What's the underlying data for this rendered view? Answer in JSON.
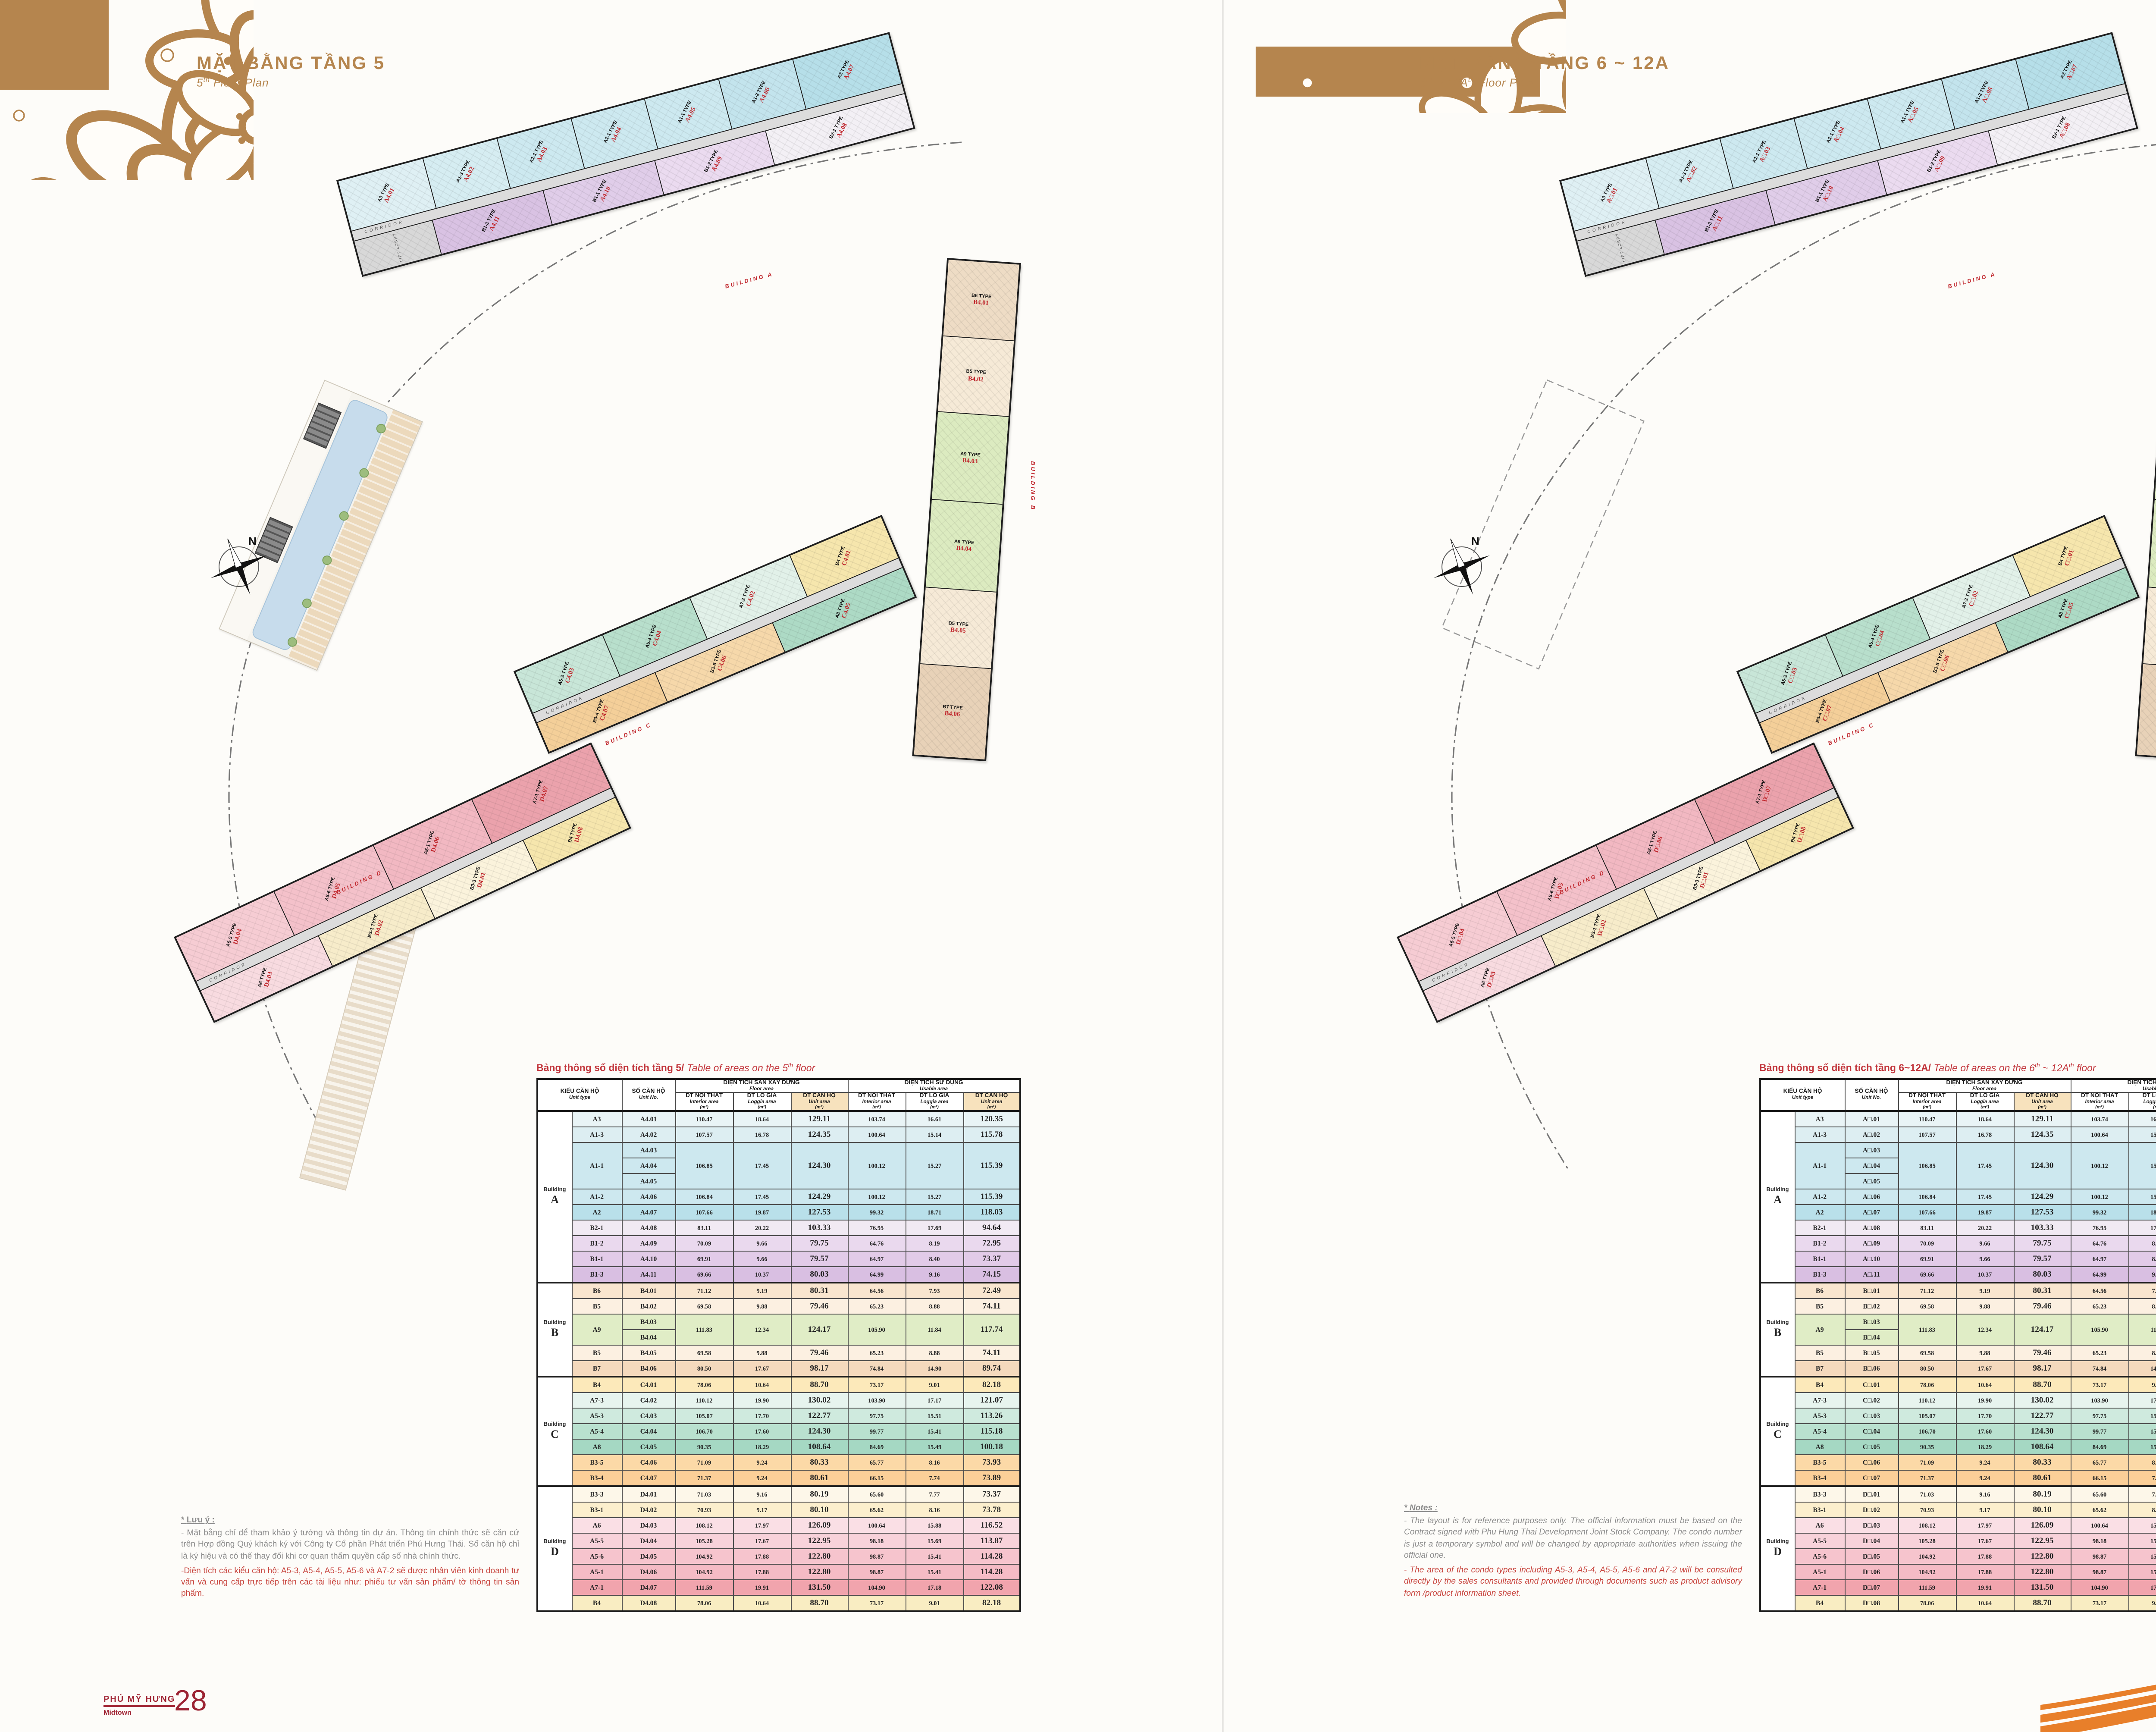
{
  "doc": {
    "edge_date": "02/03/2019"
  },
  "colors": {
    "gold": "#b5854e",
    "red_label": "#c0272d",
    "caption_red": "#c2363c",
    "footer_red": "#9c2433",
    "header_highlight": "#f7e2bd",
    "swoosh_orange": "#e87f2a"
  },
  "pages": {
    "left": {
      "title": "MẶT BẰNG TẦNG 5",
      "subtitle_parts": [
        {
          "t": "5"
        },
        {
          "t": "th",
          "sup": true
        },
        {
          "t": " Floor Plan"
        }
      ],
      "floor_token": "4",
      "table_caption_vi": "Bảng thông số diện tích tầng 5/",
      "table_caption_en_parts": [
        {
          "t": " Table of areas on the "
        },
        {
          "t": "5"
        },
        {
          "t": "th",
          "sup": true
        },
        {
          "t": " floor"
        }
      ],
      "notes": {
        "heading_star": "* ",
        "heading": "Lưu ý",
        "heading_colon": " :",
        "body": "- Mặt bằng chỉ để tham khảo ý tưởng và thông tin dự án. Thông tin chính thức sẽ căn cứ trên Hợp đồng Quý khách ký với Công ty Cổ phần Phát triển Phú Hưng Thái. Số căn hộ chỉ là ký hiệu và có thể thay đổi khi cơ quan thẩm quyền cấp số nhà chính thức.",
        "body_red": "-Diện tích các kiểu căn hộ: A5-3, A5-4, A5-5, A5-6 và A7-2 sẽ được nhân viên kinh doanh tư vấn và cung cấp trực tiếp trên các tài liệu như: phiếu tư vấn sản phẩm/ tờ thông tin sản phẩm."
      },
      "footer": {
        "brand": "PHÚ MỸ HƯNG",
        "brand_sub": "Midtown",
        "page_no": "28"
      }
    },
    "right": {
      "title": "MẶT BẰNG TẦNG 6 ~ 12A",
      "subtitle_parts": [
        {
          "t": "6"
        },
        {
          "t": "th",
          "sup": true
        },
        {
          "t": " ~ 12A"
        },
        {
          "t": "th",
          "sup": true
        },
        {
          "t": " Floor Plan"
        }
      ],
      "floor_token": "□",
      "table_caption_vi": "Bảng thông số diện tích tầng 6~12A/",
      "table_caption_en_parts": [
        {
          "t": " Table of areas on the "
        },
        {
          "t": "6"
        },
        {
          "t": "th",
          "sup": true
        },
        {
          "t": " ~ 12A"
        },
        {
          "t": "th",
          "sup": true
        },
        {
          "t": " floor"
        }
      ],
      "notes": {
        "heading_star": "* ",
        "heading": "Notes",
        "heading_colon": " :",
        "body": "- The layout is for reference purposes only. The official information must be based on the Contract signed with Phu Hung Thai Development Joint Stock Company. The condo number is just a temporary symbol and will be changed by appropriate authorities when issuing the official one.",
        "body_red": "- The area of the condo types including A5-3, A5-4, A5-5, A5-6 and A7-2 will be consulted directly by the sales consultants and provided through documents such as product advisory form /product information sheet."
      },
      "footer": {
        "brand": "THE PEAK",
        "brand_sub": "Building A - B - C - D",
        "page_no": "29"
      }
    }
  },
  "table": {
    "building_word": "Building",
    "headers": {
      "unit_type_vi": "KIỂU CĂN HỘ",
      "unit_type_en": "Unit type",
      "unit_no_vi": "SỐ CĂN HỘ",
      "unit_no_en": "Unit No.",
      "floor_vi": "DIỆN TÍCH SÀN XÂY DỰNG",
      "floor_en": "Floor area",
      "usable_vi": "DIỆN TÍCH SỬ DỤNG",
      "usable_en": "Usable area",
      "m2": "(m²)",
      "sub": [
        {
          "vi": "DT NỘI THẤT",
          "en": "Interior area"
        },
        {
          "vi": "DT LÔ GIA",
          "en": "Loggia area"
        },
        {
          "vi": "DT CĂN HỘ",
          "en": "Unit area"
        }
      ]
    },
    "groups": [
      {
        "letter": "A",
        "rows": [
          {
            "type": "A3",
            "units": [
              {
                "b": "A",
                "s": ".01"
              }
            ],
            "v": [
              "110.47",
              "18.64",
              "129.11",
              "103.74",
              "16.61",
              "120.35"
            ],
            "tint": "#e9f4f6"
          },
          {
            "type": "A1-3",
            "units": [
              {
                "b": "A",
                "s": ".02"
              }
            ],
            "v": [
              "107.57",
              "16.78",
              "124.35",
              "100.64",
              "15.14",
              "115.78"
            ],
            "tint": "#ddeef2"
          },
          {
            "type": "A1-1",
            "units": [
              {
                "b": "A",
                "s": ".03"
              },
              {
                "b": "A",
                "s": ".04"
              },
              {
                "b": "A",
                "s": ".05"
              }
            ],
            "v": [
              "106.85",
              "17.45",
              "124.30",
              "100.12",
              "15.27",
              "115.39"
            ],
            "tint": "#cde8ef"
          },
          {
            "type": "A1-2",
            "units": [
              {
                "b": "A",
                "s": ".06"
              }
            ],
            "v": [
              "106.84",
              "17.45",
              "124.29",
              "100.12",
              "15.27",
              "115.39"
            ],
            "tint": "#cde8ef"
          },
          {
            "type": "A2",
            "units": [
              {
                "b": "A",
                "s": ".07"
              }
            ],
            "v": [
              "107.66",
              "19.87",
              "127.53",
              "99.32",
              "18.71",
              "118.03"
            ],
            "tint": "#b9e0ea"
          },
          {
            "type": "B2-1",
            "units": [
              {
                "b": "A",
                "s": ".08"
              }
            ],
            "v": [
              "83.11",
              "20.22",
              "103.33",
              "76.95",
              "17.69",
              "94.64"
            ],
            "tint": "#f1eaf3"
          },
          {
            "type": "B1-2",
            "units": [
              {
                "b": "A",
                "s": ".09"
              }
            ],
            "v": [
              "70.09",
              "9.66",
              "79.75",
              "64.76",
              "8.19",
              "72.95"
            ],
            "tint": "#ead9ee"
          },
          {
            "type": "B1-1",
            "units": [
              {
                "b": "A",
                "s": ".10"
              }
            ],
            "v": [
              "69.91",
              "9.66",
              "79.57",
              "64.97",
              "8.40",
              "73.37"
            ],
            "tint": "#e2cbe8"
          },
          {
            "type": "B1-3",
            "units": [
              {
                "b": "A",
                "s": ".11"
              }
            ],
            "v": [
              "69.66",
              "10.37",
              "80.03",
              "64.99",
              "9.16",
              "74.15"
            ],
            "tint": "#d9bfe2"
          }
        ]
      },
      {
        "letter": "B",
        "rows": [
          {
            "type": "B6",
            "units": [
              {
                "b": "B",
                "s": ".01"
              }
            ],
            "v": [
              "71.12",
              "9.19",
              "80.31",
              "64.56",
              "7.93",
              "72.49"
            ],
            "tint": "#f9e6cf"
          },
          {
            "type": "B5",
            "units": [
              {
                "b": "B",
                "s": ".02"
              }
            ],
            "v": [
              "69.58",
              "9.88",
              "79.46",
              "65.23",
              "8.88",
              "74.11"
            ],
            "tint": "#fcf0e1"
          },
          {
            "type": "A9",
            "units": [
              {
                "b": "B",
                "s": ".03"
              },
              {
                "b": "B",
                "s": ".04"
              }
            ],
            "v": [
              "111.83",
              "12.34",
              "124.17",
              "105.90",
              "11.84",
              "117.74"
            ],
            "tint": "#e0edc6"
          },
          {
            "type": "B5",
            "units": [
              {
                "b": "B",
                "s": ".05"
              }
            ],
            "v": [
              "69.58",
              "9.88",
              "79.46",
              "65.23",
              "8.88",
              "74.11"
            ],
            "tint": "#fcf0e1"
          },
          {
            "type": "B7",
            "units": [
              {
                "b": "B",
                "s": ".06"
              }
            ],
            "v": [
              "80.50",
              "17.67",
              "98.17",
              "74.84",
              "14.90",
              "89.74"
            ],
            "tint": "#f4d9bd"
          }
        ]
      },
      {
        "letter": "C",
        "rows": [
          {
            "type": "B4",
            "units": [
              {
                "b": "C",
                "s": ".01"
              }
            ],
            "v": [
              "78.06",
              "10.64",
              "88.70",
              "73.17",
              "9.01",
              "82.18"
            ],
            "tint": "#fce9ba"
          },
          {
            "type": "A7-3",
            "units": [
              {
                "b": "C",
                "s": ".02"
              }
            ],
            "v": [
              "110.12",
              "19.90",
              "130.02",
              "103.90",
              "17.17",
              "121.07"
            ],
            "tint": "#e7f4ee"
          },
          {
            "type": "A5-3",
            "units": [
              {
                "b": "C",
                "s": ".03"
              }
            ],
            "v": [
              "105.07",
              "17.70",
              "122.77",
              "97.75",
              "15.51",
              "113.26"
            ],
            "tint": "#cfeade"
          },
          {
            "type": "A5-4",
            "units": [
              {
                "b": "C",
                "s": ".04"
              }
            ],
            "v": [
              "106.70",
              "17.60",
              "124.30",
              "99.77",
              "15.41",
              "115.18"
            ],
            "tint": "#b9e1cf"
          },
          {
            "type": "A8",
            "units": [
              {
                "b": "C",
                "s": ".05"
              }
            ],
            "v": [
              "90.35",
              "18.29",
              "108.64",
              "84.69",
              "15.49",
              "100.18"
            ],
            "tint": "#a5d8c3"
          },
          {
            "type": "B3-5",
            "units": [
              {
                "b": "C",
                "s": ".06"
              }
            ],
            "v": [
              "71.09",
              "9.24",
              "80.33",
              "65.77",
              "8.16",
              "73.93"
            ],
            "tint": "#fcd9a7"
          },
          {
            "type": "B3-4",
            "units": [
              {
                "b": "C",
                "s": ".07"
              }
            ],
            "v": [
              "71.37",
              "9.24",
              "80.61",
              "66.15",
              "7.74",
              "73.89"
            ],
            "tint": "#fbcf98"
          }
        ]
      },
      {
        "letter": "D",
        "rows": [
          {
            "type": "B3-3",
            "units": [
              {
                "b": "D",
                "s": ".01"
              }
            ],
            "v": [
              "71.03",
              "9.16",
              "80.19",
              "65.60",
              "7.77",
              "73.37"
            ],
            "tint": "#fdf7e9"
          },
          {
            "type": "B3-1",
            "units": [
              {
                "b": "D",
                "s": ".02"
              }
            ],
            "v": [
              "70.93",
              "9.17",
              "80.10",
              "65.62",
              "8.16",
              "73.78"
            ],
            "tint": "#fcefcd"
          },
          {
            "type": "A6",
            "units": [
              {
                "b": "D",
                "s": ".03"
              }
            ],
            "v": [
              "108.12",
              "17.97",
              "126.09",
              "100.64",
              "15.88",
              "116.52"
            ],
            "tint": "#fadfe5"
          },
          {
            "type": "A5-5",
            "units": [
              {
                "b": "D",
                "s": ".04"
              }
            ],
            "v": [
              "105.28",
              "17.67",
              "122.95",
              "98.18",
              "15.69",
              "113.87"
            ],
            "tint": "#f8d2da"
          },
          {
            "type": "A5-6",
            "units": [
              {
                "b": "D",
                "s": ".05"
              }
            ],
            "v": [
              "104.92",
              "17.88",
              "122.80",
              "98.87",
              "15.41",
              "114.28"
            ],
            "tint": "#f6c4cd"
          },
          {
            "type": "A5-1",
            "units": [
              {
                "b": "D",
                "s": ".06"
              }
            ],
            "v": [
              "104.92",
              "17.88",
              "122.80",
              "98.87",
              "15.41",
              "114.28"
            ],
            "tint": "#f5bbc5"
          },
          {
            "type": "A7-1",
            "units": [
              {
                "b": "D",
                "s": ".07"
              }
            ],
            "v": [
              "111.59",
              "19.91",
              "131.50",
              "104.90",
              "17.18",
              "122.08"
            ],
            "tint": "#f1a4ad"
          },
          {
            "type": "B4",
            "units": [
              {
                "b": "D",
                "s": ".08"
              }
            ],
            "v": [
              "78.06",
              "10.64",
              "88.70",
              "73.17",
              "9.01",
              "82.18"
            ],
            "tint": "#f9edc2"
          }
        ]
      }
    ]
  },
  "plan": {
    "corridor_label": "CORRIDOR",
    "lift_label": "LIFT LOBBY",
    "north_label": "N",
    "building_labels": [
      "BUILDING A",
      "BUILDING B",
      "BUILDING C",
      "BUILDING D"
    ],
    "bands": {
      "A_top": [
        {
          "t": "A3 TYPE",
          "b": "A",
          "s": ".01",
          "c": "#dff0f4",
          "f": 1.15
        },
        {
          "t": "A1-3 TYPE",
          "b": "A",
          "s": ".02",
          "c": "#d6edf2"
        },
        {
          "t": "A1-1 TYPE",
          "b": "A",
          "s": ".03",
          "c": "#cde9f0"
        },
        {
          "t": "A1-1 TYPE",
          "b": "A",
          "s": ".04",
          "c": "#cde9f0"
        },
        {
          "t": "A1-1 TYPE",
          "b": "A",
          "s": ".05",
          "c": "#cde9f0"
        },
        {
          "t": "A1-2 TYPE",
          "b": "A",
          "s": ".06",
          "c": "#c3e4ed"
        },
        {
          "t": "A2 TYPE",
          "b": "A",
          "s": ".07",
          "c": "#b6dfe9",
          "f": 1.3
        }
      ],
      "A_bot": [
        {
          "t": "",
          "c": "#d8d8d8",
          "f": 0.7
        },
        {
          "t": "B1-3 TYPE",
          "b": "A",
          "s": ".11",
          "c": "#d9c2e3"
        },
        {
          "t": "B1-1 TYPE",
          "b": "A",
          "s": ".10",
          "c": "#e0cde9"
        },
        {
          "t": "B1-2 TYPE",
          "b": "A",
          "s": ".09",
          "c": "#ebdbf0"
        },
        {
          "t": "B2-1 TYPE",
          "b": "A",
          "s": ".08",
          "c": "#f3f0f5",
          "f": 1.25
        }
      ],
      "B": [
        {
          "t": "B6 TYPE",
          "b": "B",
          "s": ".01",
          "c": "#eedcc5"
        },
        {
          "t": "B5 TYPE",
          "b": "B",
          "s": ".02",
          "c": "#f6ead7"
        },
        {
          "t": "A9 TYPE",
          "b": "B",
          "s": ".03",
          "c": "#dcebc0",
          "f": 1.15
        },
        {
          "t": "A9 TYPE",
          "b": "B",
          "s": ".04",
          "c": "#dcebc0",
          "f": 1.15
        },
        {
          "t": "B5 TYPE",
          "b": "B",
          "s": ".05",
          "c": "#f6ead7"
        },
        {
          "t": "B7 TYPE",
          "b": "B",
          "s": ".06",
          "c": "#e8d2b8",
          "f": 1.2
        }
      ],
      "C_top": [
        {
          "t": "A5-3 TYPE",
          "b": "C",
          "s": ".03",
          "c": "#c8e6d8"
        },
        {
          "t": "A5-4 TYPE",
          "b": "C",
          "s": ".04",
          "c": "#b8dfcc"
        },
        {
          "t": "A7-3 TYPE",
          "b": "C",
          "s": ".02",
          "c": "#e2f1e9",
          "f": 1.15
        },
        {
          "t": "B4 TYPE",
          "b": "C",
          "s": ".01",
          "c": "#f6e6ad",
          "f": 1.05
        }
      ],
      "C_bot": [
        {
          "t": "B3-4 TYPE",
          "b": "C",
          "s": ".07",
          "c": "#f4cf99"
        },
        {
          "t": "B3-5 TYPE",
          "b": "C",
          "s": ".06",
          "c": "#f6d8aa"
        },
        {
          "t": "A8 TYPE",
          "b": "C",
          "s": ".05",
          "c": "#addac5",
          "f": 1.1
        }
      ],
      "D_top": [
        {
          "t": "A5-5 TYPE",
          "b": "D",
          "s": ".04",
          "c": "#f6ccd3"
        },
        {
          "t": "A5-6 TYPE",
          "b": "D",
          "s": ".05",
          "c": "#f4c1ca"
        },
        {
          "t": "A5-1 TYPE",
          "b": "D",
          "s": ".06",
          "c": "#f2b8c2"
        },
        {
          "t": "A7-1 TYPE",
          "b": "D",
          "s": ".07",
          "c": "#eba2ac",
          "f": 1.2
        }
      ],
      "D_bot": [
        {
          "t": "A6 TYPE",
          "b": "D",
          "s": ".03",
          "c": "#f8dbe0",
          "f": 1.15
        },
        {
          "t": "B3-1 TYPE",
          "b": "D",
          "s": ".02",
          "c": "#f7ecca"
        },
        {
          "t": "B3-3 TYPE",
          "b": "D",
          "s": ".01",
          "c": "#fbf3dc"
        },
        {
          "t": "B4 TYPE",
          "b": "D",
          "s": ".08",
          "c": "#f6e6ad",
          "f": 0.9
        }
      ]
    }
  }
}
